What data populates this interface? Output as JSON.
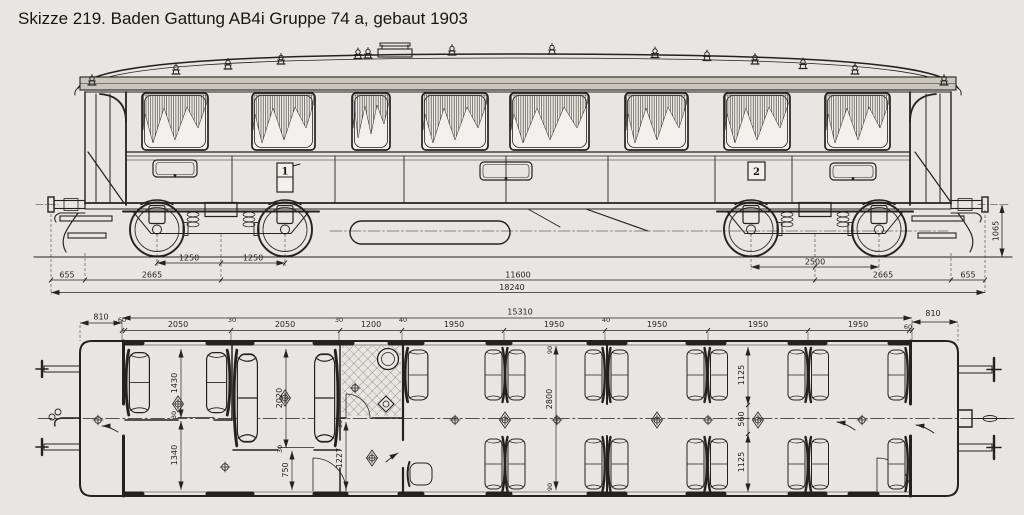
{
  "title": "Skizze 219. Baden Gattung AB4i Gruppe 74 a, gebaut 1903",
  "elevation": {
    "class_first": "1",
    "class_second": "2",
    "dims": {
      "axle_a": "1250",
      "axle_b": "1250",
      "bogie_wheelbase": "2500",
      "overhang_left": "655",
      "pivot_left": "2665",
      "pivot_right": "2665",
      "overhang_right": "655",
      "pivot_distance": "11600",
      "length_over_buffers": "18240",
      "buffer_height": "1065"
    }
  },
  "plan": {
    "overhang_left": "810",
    "interior_length": "15310",
    "overhang_right": "810",
    "top_dims": [
      "60",
      "2050",
      "30",
      "2050",
      "30",
      "1200",
      "40",
      "1950",
      "1950",
      "40",
      "1950",
      "1950",
      "1950",
      "60"
    ],
    "v_dims": {
      "comp1": "1430",
      "wall_a": "30",
      "corridor": "1340",
      "comp2": "2020",
      "wall_b": "30",
      "door": "750",
      "wall_c": "30",
      "vestibule": "1227",
      "wall_top": "90",
      "width": "2800",
      "wall_bottom": "90",
      "seat_top": "1125",
      "aisle": "560",
      "seat_bottom": "1125"
    }
  }
}
